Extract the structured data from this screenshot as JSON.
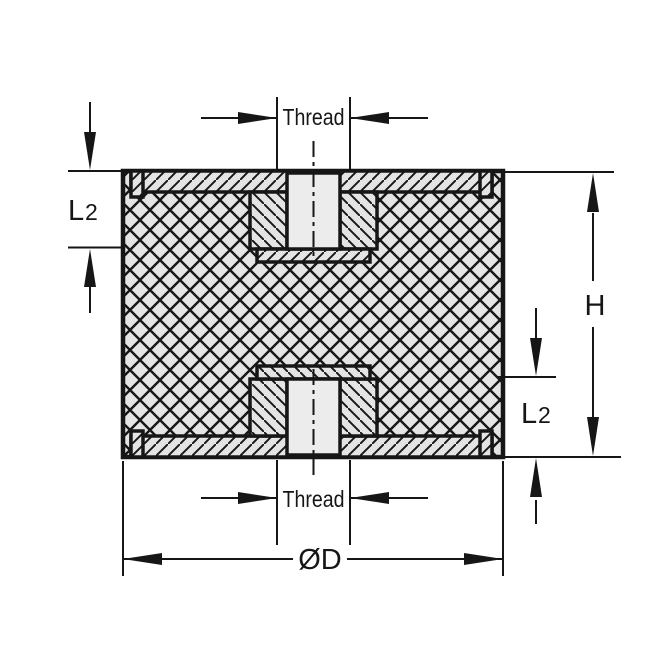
{
  "labels": {
    "thread_top": "Thread",
    "thread_bottom": "Thread",
    "l2_left_main": "L",
    "l2_left_sub": "2",
    "l2_right_main": "L",
    "l2_right_sub": "2",
    "height": "H",
    "diameter": "ØD"
  },
  "colors": {
    "line": "#161616",
    "part_fill": "#e4e4e4",
    "hole_fill": "#ececec",
    "background": "#ffffff"
  }
}
